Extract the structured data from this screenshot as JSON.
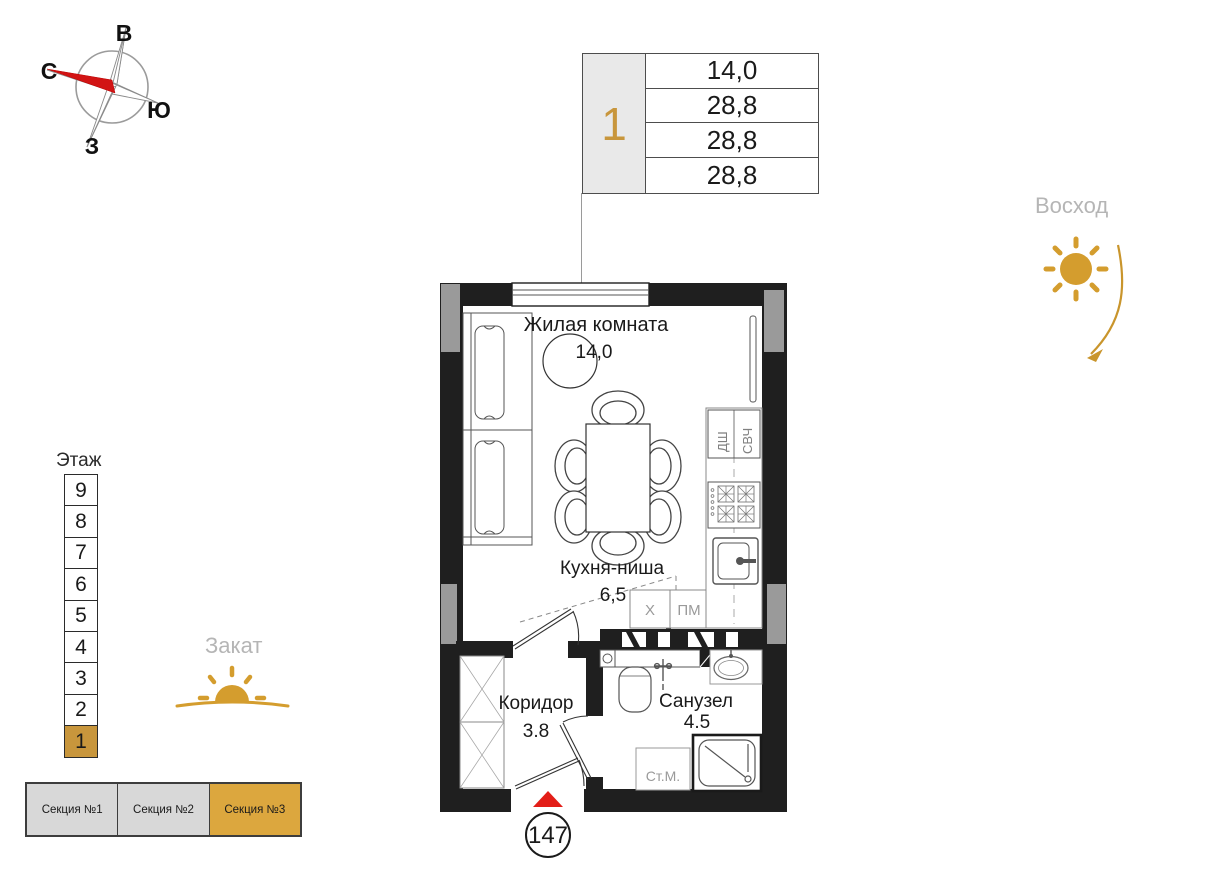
{
  "compass": {
    "east": "В",
    "north": "С",
    "south": "Ю",
    "west": "З"
  },
  "info_table": {
    "unit": "1",
    "rows": [
      "14,0",
      "28,8",
      "28,8",
      "28,8"
    ]
  },
  "sunrise": {
    "label": "Восход"
  },
  "sunset": {
    "label": "Закат"
  },
  "floors": {
    "label": "Этаж",
    "items": [
      "9",
      "8",
      "7",
      "6",
      "5",
      "4",
      "3",
      "2",
      "1"
    ]
  },
  "sections": {
    "items": [
      {
        "label": "Секция №1"
      },
      {
        "label": "Секция №2"
      },
      {
        "label": "Секция №3"
      }
    ]
  },
  "plan": {
    "rooms": [
      {
        "name": "Жилая комната",
        "area": "14,0"
      },
      {
        "name": "Кухня-ниша",
        "area": "6,5"
      },
      {
        "name": "Коридор",
        "area": "3.8"
      },
      {
        "name": "Санузел",
        "area": "4.5"
      }
    ],
    "appliances": {
      "oven": "ДШ",
      "microwave": "СВЧ",
      "fridge": "Х",
      "dishwasher": "ПМ",
      "washer": "Ст.М."
    },
    "unit_number": "147"
  },
  "colors": {
    "accent_gold": "#C8963C",
    "entry_red": "#E31E18",
    "wall_black": "#1F1F1F",
    "wall_gray": "#9A9A9A",
    "muted_text": "#B3B3B3"
  }
}
